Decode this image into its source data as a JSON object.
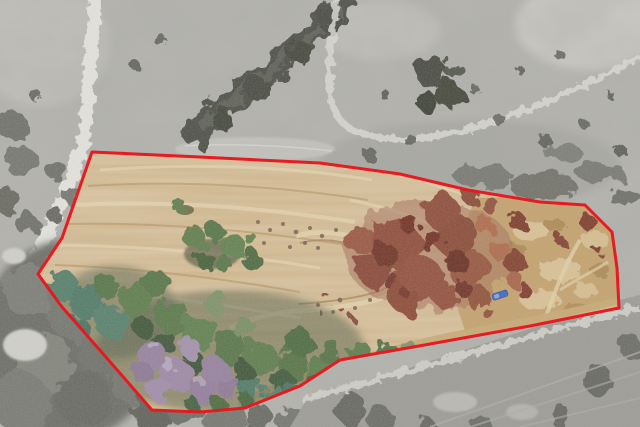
{
  "image": {
    "kind": "aerial-parcel-photo",
    "width_px": 640,
    "height_px": 427,
    "description": "Overhead aerial photo of a cleared land parcel outlined in red; ground inside the boundary is in color, surrounding terrain is desaturated gray"
  },
  "boundary": {
    "color": "#e8161d",
    "stroke_width": 3,
    "points_str": "92,152 200,157 320,163 400,174 468,190 540,202 585,205 612,232 617,268 619,308 530,326 430,344 340,360 300,386 245,408 200,412 152,410 98,348 62,307 38,274 62,238",
    "vertex_count": 21
  },
  "palette": {
    "outside_base": "#b5b4af",
    "road": "#e6e5e0",
    "trail": "#dcdbd5",
    "dirt": "#d2b385",
    "straw": "#c9aa74",
    "grass_gold": "#c5a26c",
    "brush_red": "#8f4c39",
    "tree_green": "#5d7b4c",
    "tree_teal": "#4f7a66",
    "tree_purple": "#97819f",
    "tree_gray": "#6c6d66",
    "vehicle_blue": "#3a66c4"
  },
  "features": {
    "parcel": "graded dirt pad with terrace lines and a loop track",
    "vegetation_inside": "green, teal and purple tree canopy along the south edge; red-brown dead brush on the east half; golden dry grass at the east end",
    "vegetation_outside": "desaturated gray oak trees and scrub hillside",
    "roads": "light dirt road along the west side, narrow trail to the north, service road along the southeast boundary",
    "vehicle": "small blue vehicle parked near the east brush area"
  }
}
